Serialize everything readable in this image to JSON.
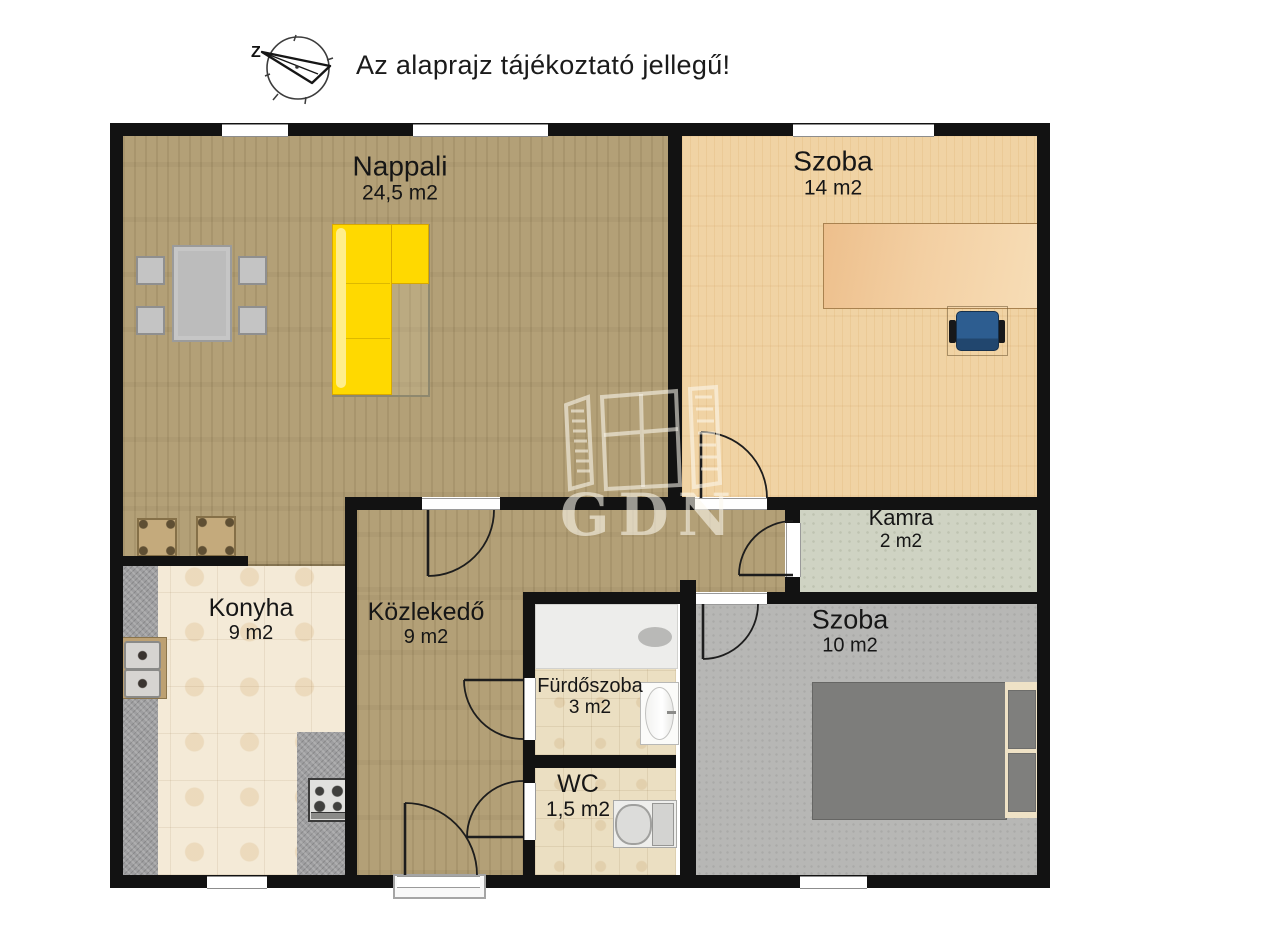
{
  "header": {
    "note": "Az alaprajz tájékoztató jellegű!",
    "compass_label": "Z"
  },
  "watermark": {
    "text": "GDN"
  },
  "rooms": {
    "nappali": {
      "name": "Nappali",
      "area": "24,5 m2"
    },
    "szoba_felso": {
      "name": "Szoba",
      "area": "14 m2"
    },
    "kamra": {
      "name": "Kamra",
      "area": "2 m2"
    },
    "konyha": {
      "name": "Konyha",
      "area": "9 m2"
    },
    "kozlekedo": {
      "name": "Közlekedő",
      "area": "9 m2"
    },
    "furdoszoba": {
      "name": "Fürdőszoba",
      "area": "3 m2"
    },
    "wc": {
      "name": "WC",
      "area": "1,5 m2"
    },
    "szoba_also": {
      "name": "Szoba",
      "area": "10 m2"
    }
  },
  "palette": {
    "wall": "#121212",
    "wood_floor": "#b3a077",
    "light_wood_floor": "#f0d3a4",
    "kitchen_tile": "#f4ead7",
    "bath_tile": "#ebdfc2",
    "pantry_floor": "#cfd3c3",
    "carpet_gray": "#b7b7b5",
    "sofa_yellow": "#ffd900",
    "desk_wood": "#f3cfa2",
    "office_chair_blue": "#2d5d90",
    "counter_granite": "#9e9ea0",
    "bed_gray": "#7d7d7b"
  }
}
